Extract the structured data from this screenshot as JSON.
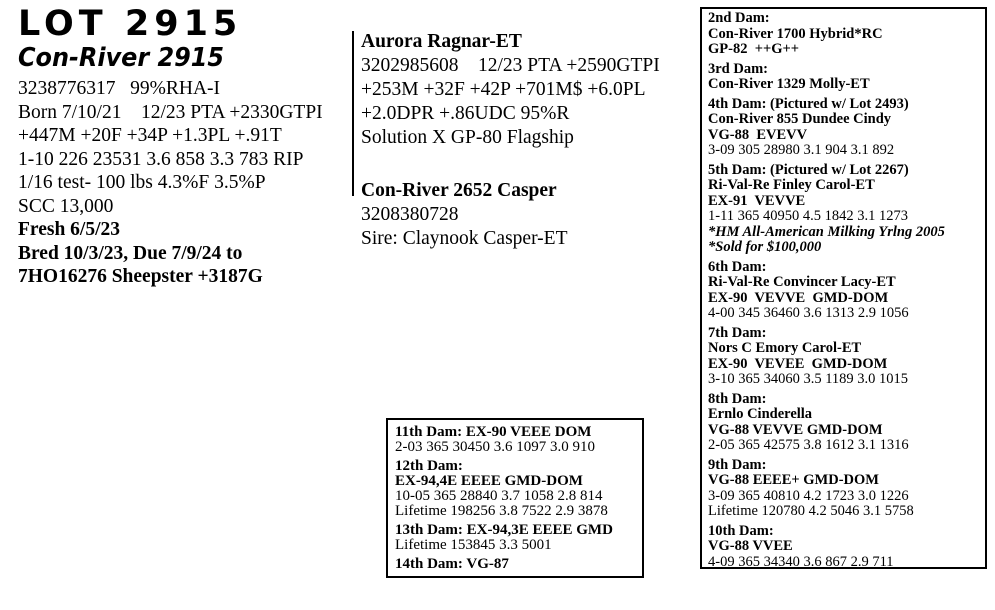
{
  "lot": {
    "title": "LOT 2915",
    "name": "Con-River 2915",
    "lines": [
      "3238776317   99%RHA-I",
      "Born 7/10/21    12/23 PTA +2330GTPI",
      "+447M +20F +34P +1.3PL +.91T",
      "1-10 226 23531 3.6 858 3.3 783 RIP",
      "1/16 test- 100 lbs 4.3%F 3.5%P",
      "SCC 13,000",
      "Fresh 6/5/23",
      "Bred 10/3/23, Due 7/9/24 to",
      "7HO16276 Sheepster +3187G"
    ]
  },
  "sire": {
    "name": "Aurora Ragnar-ET",
    "lines": [
      "3202985608    12/23 PTA +2590GTPI",
      "+253M +32F +42P +701M$ +6.0PL",
      "+2.0DPR +.86UDC 95%R",
      "Solution X GP-80 Flagship"
    ]
  },
  "dam": {
    "name": "Con-River 2652 Casper",
    "lines": [
      "3208380728",
      "Sire: Claynook Casper-ET"
    ]
  },
  "dam_box": {
    "entries": [
      {
        "heading": "2nd Dam:",
        "name": "Con-River 1700 Hybrid*RC",
        "score": "GP-82  ++G++"
      },
      {
        "heading": "3rd Dam:",
        "name": "Con-River 1329 Molly-ET"
      },
      {
        "heading": "4th Dam: (Pictured w/ Lot 2493)",
        "name": "Con-River 855 Dundee Cindy",
        "score": "VG-88  EVEVV",
        "record": "3-09 305 28980 3.1 904 3.1 892"
      },
      {
        "heading": "5th Dam: (Pictured w/ Lot 2267)",
        "name": "Ri-Val-Re Finley Carol-ET",
        "score": "EX-91  VEVVE",
        "record": "1-11 365 40950 4.5 1842 3.1 1273",
        "note1": "*HM All-American Milking Yrlng 2005",
        "note2": "*Sold for $100,000"
      },
      {
        "heading": "6th Dam:",
        "name": "Ri-Val-Re Convincer Lacy-ET",
        "score": "EX-90  VEVVE  GMD-DOM",
        "record": "4-00 345 36460 3.6 1313 2.9 1056"
      },
      {
        "heading": "7th Dam:",
        "name": "Nors C Emory Carol-ET",
        "score": "EX-90  VEVEE  GMD-DOM",
        "record": "3-10 365 34060 3.5 1189 3.0 1015"
      },
      {
        "heading": "8th Dam:",
        "name": "Ernlo Cinderella",
        "score": "VG-88 VEVVE GMD-DOM",
        "record": "2-05 365 42575 3.8 1612 3.1 1316"
      },
      {
        "heading": "9th Dam:",
        "score": "VG-88 EEEE+ GMD-DOM",
        "record": "3-09 365 40810 4.2 1723 3.0 1226",
        "lifetime": "Lifetime 120780 4.2 5046 3.1 5758"
      },
      {
        "heading": "10th Dam:",
        "score": "VG-88 VVEE",
        "record": "4-09 365 34340 3.6 867 2.9 711"
      }
    ]
  },
  "ext_box": {
    "entries": [
      {
        "heading": "11th Dam: EX-90 VEEE DOM",
        "record": "2-03 365 30450 3.6 1097 3.0 910"
      },
      {
        "heading": "12th Dam:",
        "score": "EX-94,4E EEEE GMD-DOM",
        "record": "10-05 365 28840 3.7 1058 2.8 814",
        "lifetime": "Lifetime 198256 3.8 7522 2.9 3878"
      },
      {
        "heading": "13th Dam: EX-94,3E EEEE GMD",
        "lifetime": "Lifetime 153845 3.3 5001"
      },
      {
        "heading": "14th Dam: VG-87"
      }
    ]
  }
}
